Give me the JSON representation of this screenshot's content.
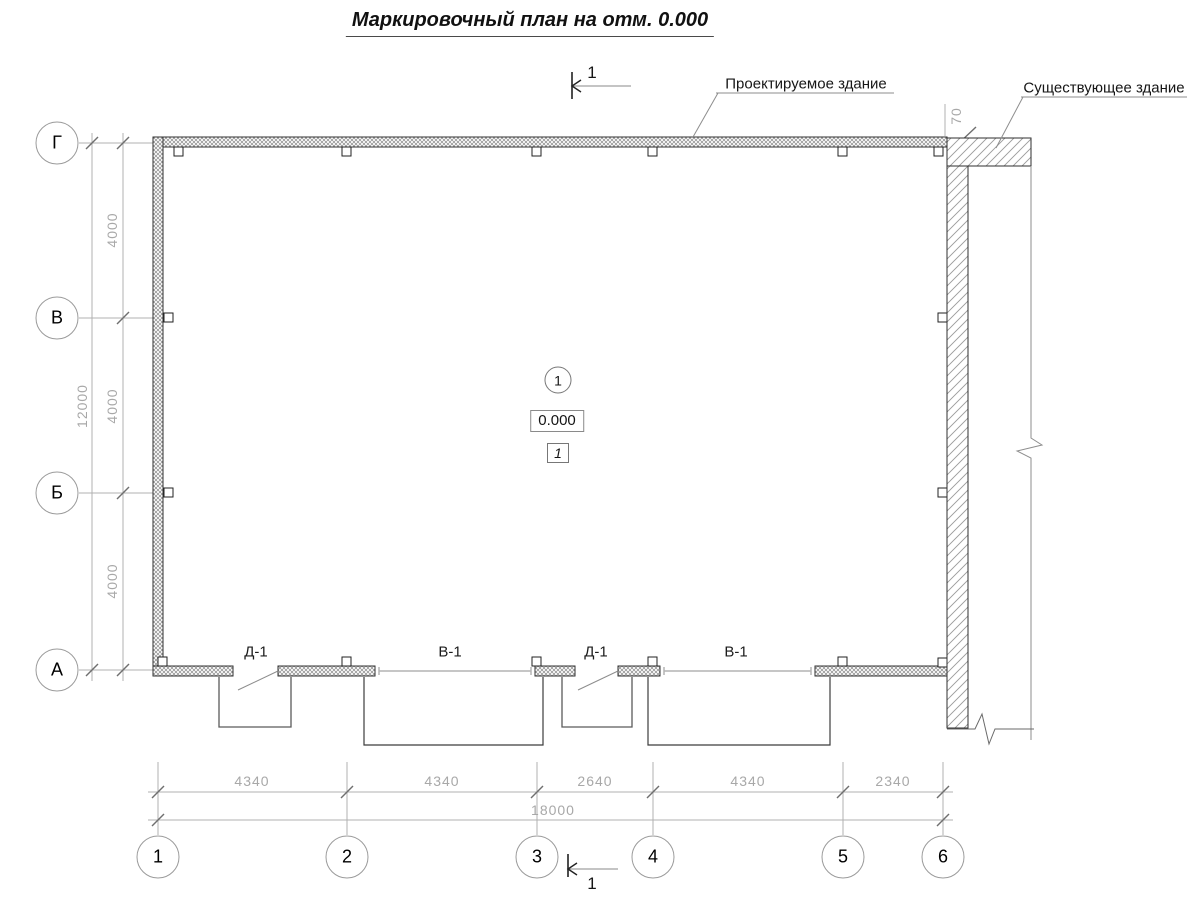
{
  "title": "Маркировочный план на отм. 0.000",
  "labels": {
    "new_building": "Проектируемое здание",
    "existing_building": "Существующее здание"
  },
  "section": {
    "top": "1",
    "bottom": "1"
  },
  "markers": {
    "axis_circle": "1",
    "elevation": "0.000",
    "room_number": "1"
  },
  "opening_labels": [
    "Д-1",
    "В-1",
    "Д-1",
    "В-1"
  ],
  "axes": {
    "rows": [
      "Г",
      "В",
      "Б",
      "А"
    ],
    "cols": [
      "1",
      "2",
      "3",
      "4",
      "5",
      "6"
    ]
  },
  "dims": {
    "left_segments": [
      "4000",
      "4000",
      "4000"
    ],
    "left_total": "12000",
    "bottom_segments": [
      "4340",
      "4340",
      "2640",
      "4340",
      "2340"
    ],
    "bottom_total": "18000",
    "gap": "70"
  }
}
